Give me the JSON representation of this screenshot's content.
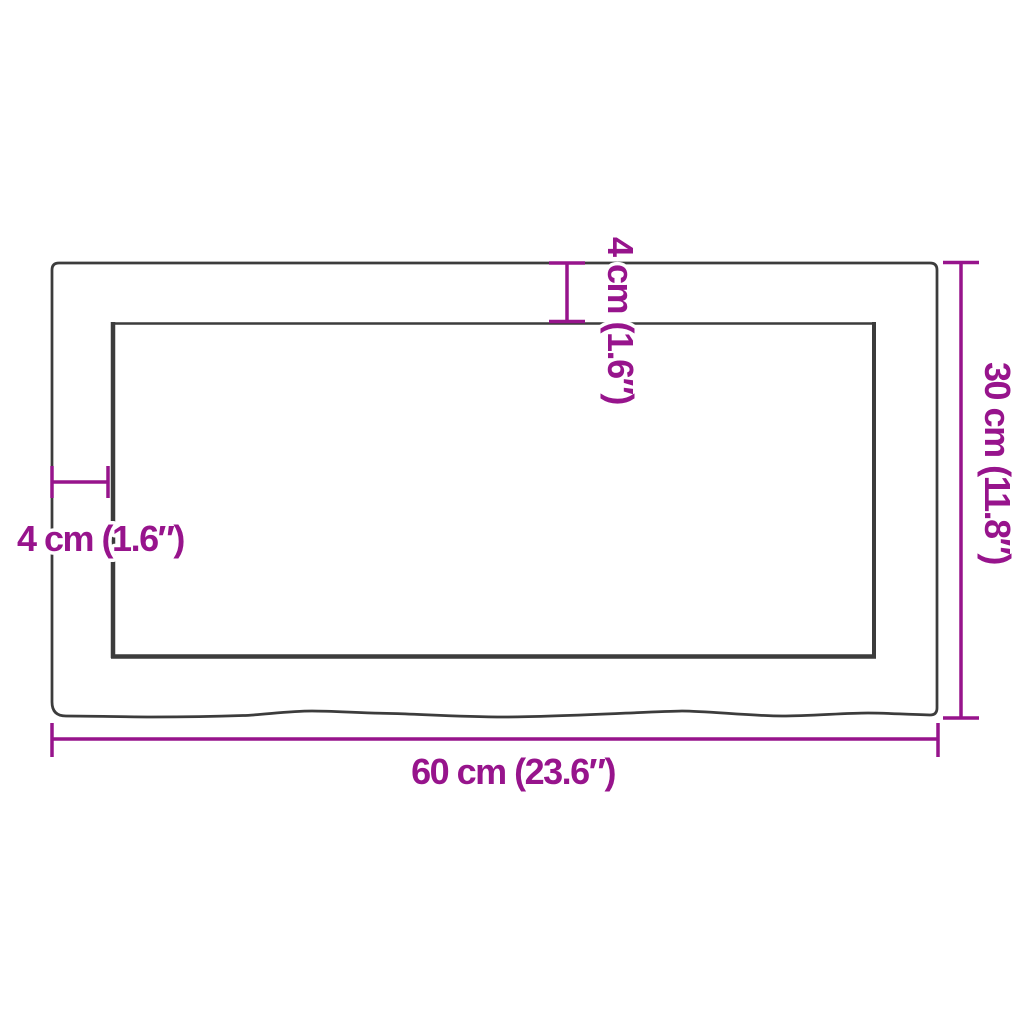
{
  "diagram": {
    "title": "shelf-dimension-diagram",
    "colors": {
      "background": "#ffffff",
      "outline": "#3c3c3c",
      "dimension": "#97148C"
    },
    "labels": {
      "width_bottom": "60 cm (23.6″)",
      "height_right": "30 cm (11.8″)",
      "thickness_top": "4 cm (1.6″)",
      "thickness_left": "4 cm (1.6″)"
    }
  }
}
